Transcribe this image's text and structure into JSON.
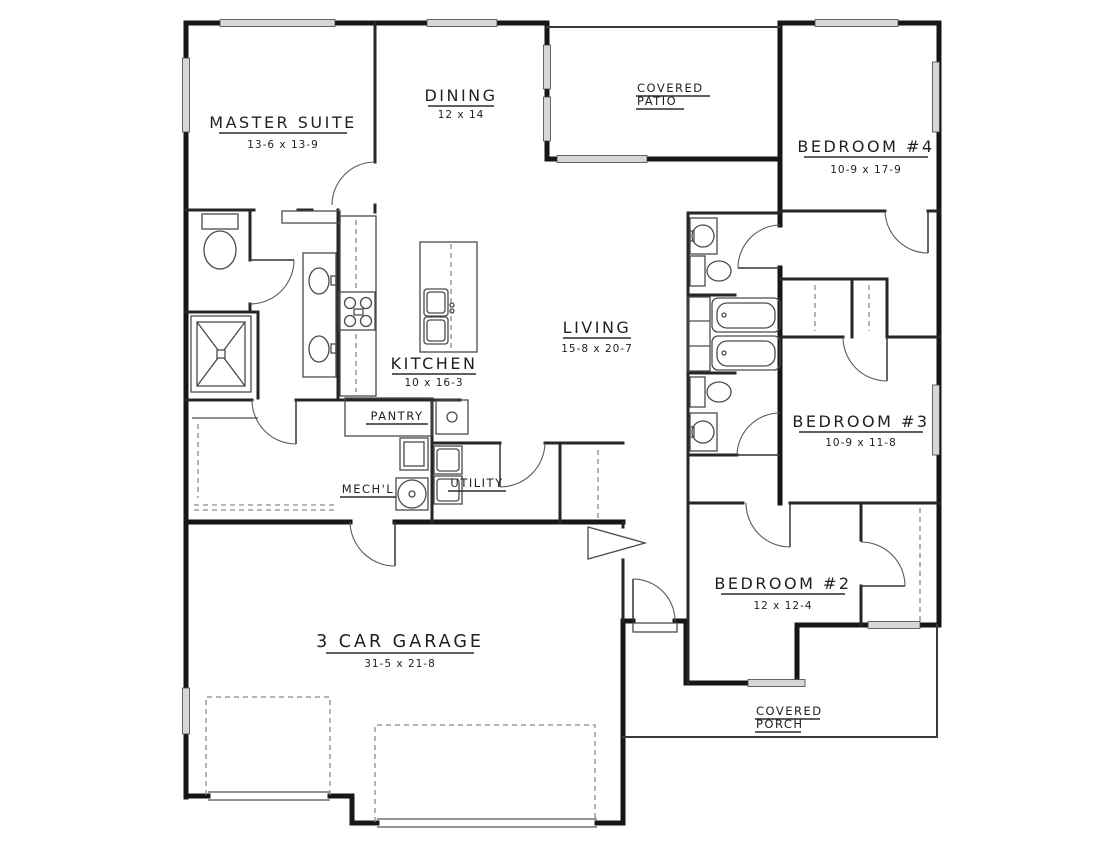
{
  "plan": {
    "rooms": [
      {
        "id": "master-suite",
        "name": "MASTER SUITE",
        "dims": "13-6 x 13-9"
      },
      {
        "id": "dining",
        "name": "DINING",
        "dims": "12 x 14"
      },
      {
        "id": "bedroom-4",
        "name": "BEDROOM #4",
        "dims": "10-9 x 17-9"
      },
      {
        "id": "living",
        "name": "LIVING",
        "dims": "15-8 x 20-7"
      },
      {
        "id": "kitchen",
        "name": "KITCHEN",
        "dims": "10 x 16-3"
      },
      {
        "id": "bedroom-3",
        "name": "BEDROOM #3",
        "dims": "10-9 x 11-8"
      },
      {
        "id": "bedroom-2",
        "name": "BEDROOM #2",
        "dims": "12 x 12-4"
      },
      {
        "id": "garage",
        "name": "3 CAR GARAGE",
        "dims": "31-5 x 21-8"
      }
    ],
    "outdoor": [
      {
        "id": "covered-patio",
        "line1": "COVERED",
        "line2": "PATIO"
      },
      {
        "id": "covered-porch",
        "line1": "COVERED",
        "line2": "PORCH"
      }
    ],
    "utility_labels": [
      {
        "id": "pantry",
        "name": "PANTRY"
      },
      {
        "id": "mechl",
        "name": "MECH'L"
      },
      {
        "id": "utility",
        "name": "UTILITY"
      }
    ],
    "colors": {
      "wall": "#161616",
      "interior_wall": "#262626",
      "thin_line": "#4a4a4a",
      "dashed_line": "#8a8a8a",
      "window_fill": "#d7d7d7",
      "background": "#ffffff",
      "text": "#1f1f1f"
    }
  }
}
